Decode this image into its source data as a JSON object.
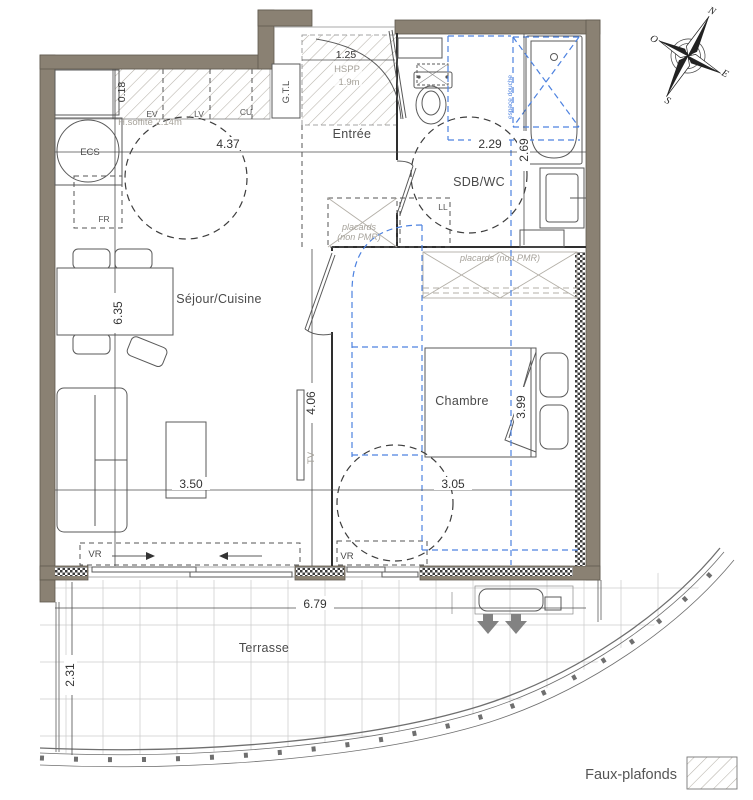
{
  "rooms": {
    "sejour": {
      "label": "Séjour/Cuisine"
    },
    "chambre": {
      "label": "Chambre"
    },
    "sdb": {
      "label": "SDB/WC"
    },
    "entree": {
      "label": "Entrée"
    },
    "terrasse": {
      "label": "Terrasse"
    }
  },
  "annotations": {
    "ecs": "ECS",
    "fr": "FR",
    "ll": "LL",
    "tv": "TV",
    "gtl": "G.T.L",
    "ev": "EV",
    "lv": "LV",
    "cu": "CU",
    "vr": "VR",
    "soffite": "H.soffite 2.14m",
    "hspp": "HSPP",
    "hspp_h": "1.9m",
    "placards_line1": "placards",
    "placards_line2": "(non PMR)",
    "placards_inline": "placards (non PMR)",
    "espace_douche": "espace douche"
  },
  "dimensions": {
    "sejour_width": "4.37",
    "sdb_width": "2.29",
    "sdb_depth": "2.69",
    "counter_depth": "0.18",
    "entree_width": "1.25",
    "sejour_height": "6.35",
    "sejour_south_height": "4.06",
    "sejour_south_width": "3.50",
    "chambre_width": "3.05",
    "chambre_depth": "3.99",
    "terrasse_width": "6.79",
    "terrasse_depth": "2.31"
  },
  "compass": {
    "north": "N",
    "west": "O",
    "east": "E",
    "south": "S"
  },
  "legend": {
    "faux_plafonds": "Faux-plafonds"
  },
  "colors": {
    "wall": "#8a8173",
    "faux_plafond_blue": "#4d82e0"
  }
}
